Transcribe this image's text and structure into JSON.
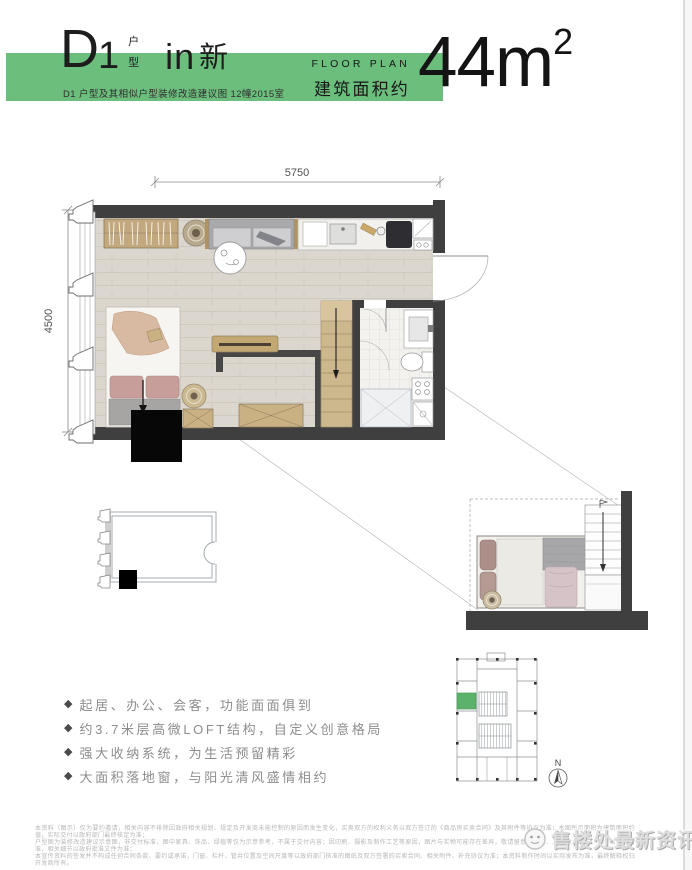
{
  "header": {
    "unit_letter": "D",
    "unit_number": "1",
    "unit_label_top": "户",
    "unit_label_bottom": "型",
    "suffix_latin": "in",
    "suffix_cn": "新",
    "subtitle": "D1 户型及其相似户型装修改造建议图 12幢2015室",
    "floor_plan_en": "FLOOR PLAN",
    "area_label": "建筑面积约",
    "area_value": "44m",
    "area_sup": "2",
    "accent_green": "#6cbe7d"
  },
  "plan": {
    "dim_width": "5750",
    "dim_height": "4500"
  },
  "key_plan": {
    "north_label": "N",
    "highlight_color": "#5cb26a"
  },
  "features": {
    "bullet": "◆",
    "items": [
      "起居、办公、会客，功能面面俱到",
      "约3.7米层高微LOFT结构，自定义创意格局",
      "强大收纳系统，为生活预留精彩",
      "大面积落地窗，与阳光清风盛情相约"
    ]
  },
  "disclaimer": {
    "lines": [
      "本资料（图示）仅为要约邀请，相关内容不排除因政府相关规划、规定及开发商未能控制的原因而发生变化，买卖双方的权利义务以双方签订的《商品房买卖合同》及其附件等协议为准；本图所示面积为建筑面积约值，实际交付以政府部门最终核定为准；",
      "户型图为装修改造建议示意图，非交付标准，图中家具、饰品、绿植等仅为示意参考，不属于交付内容；因印刷、摄影及制作工艺等原因，图片与实物可能存在差异，敬请留意；面积、尺寸均为约数，最终以实测为准，相关细节以政府批准文件为准；",
      "本宣传资料的签发并不构成任何合同条款、要约或承诺，门窗、栏杆、管井位置及空间尺度等以政府部门核准的图纸及双方签署的买卖合同、相关附件、补充协议为准；本资料制作时间以实际发布为准，最终解释权归开发商所有。"
    ]
  },
  "watermark": {
    "text": "售楼处最新资讯"
  }
}
